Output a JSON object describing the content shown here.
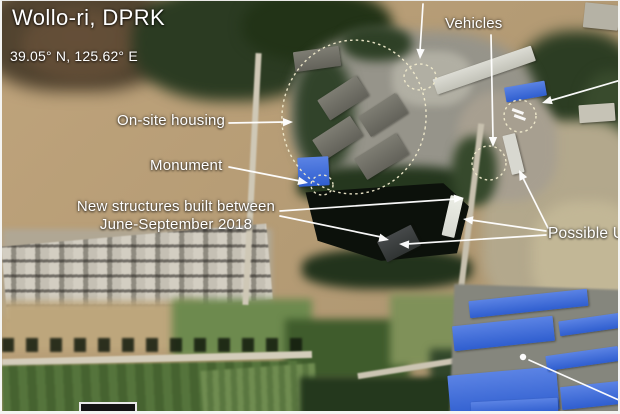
{
  "header": {
    "title": "Wollo-ri, DPRK",
    "coordinates": "39.05° N, 125.62° E"
  },
  "annotations": {
    "vehicles": {
      "label": "Vehicles"
    },
    "on_site_housing": {
      "label": "On-site housing"
    },
    "monument": {
      "label": "Monument"
    },
    "new_structures": {
      "label_line1": "New structures built between",
      "label_line2": "June-September 2018"
    },
    "possible_ugf": {
      "label": "Possible UG"
    }
  },
  "colors": {
    "annotation_text": "#ffffff",
    "arrow": "#ffffff",
    "dotted_outline": "#f1ebcd",
    "blue_roof": "#3f6cd6",
    "pond": "#0c110b"
  }
}
